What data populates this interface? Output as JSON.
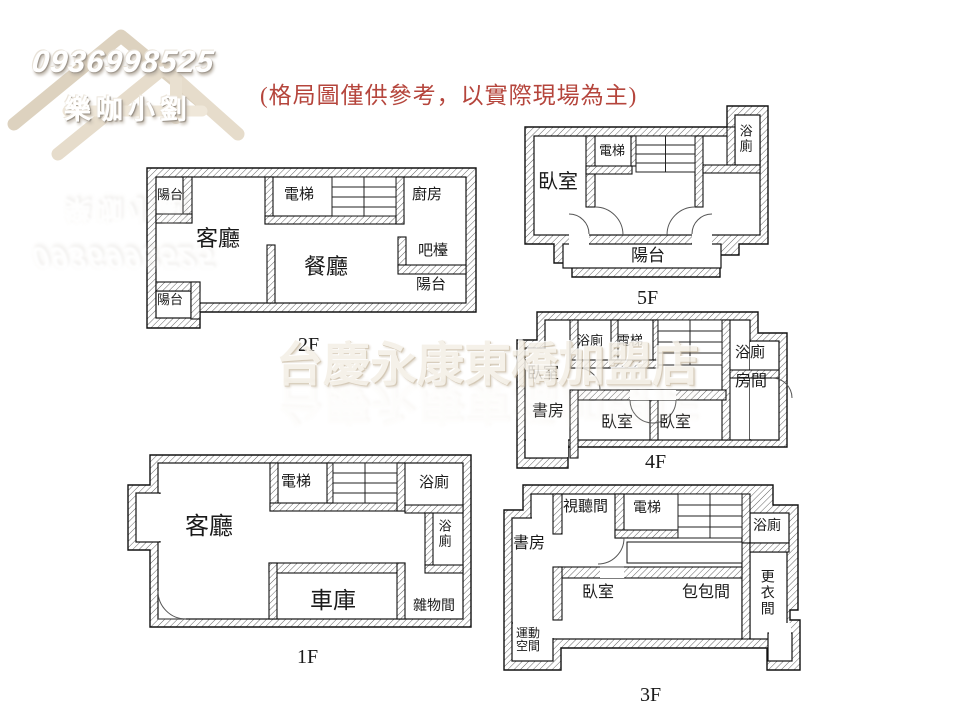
{
  "disclaimer": "(格局圖僅供參考，以實際現場為主)",
  "logo": {
    "phone": "0936998525",
    "name": "樂咖小劉"
  },
  "center_watermark": "台慶永康東橋加盟店",
  "colors": {
    "disclaimer_red": "#b5453c",
    "wall_line": "#111111",
    "hatch_line": "#666666",
    "watermark_beige": "#e9e0d1"
  },
  "floors": {
    "f1": {
      "label": "1F",
      "rooms": {
        "living": "客廳",
        "elevator": "電梯",
        "bath_top": "浴廁",
        "bath_right": "浴廁",
        "garage": "車庫",
        "storage": "雜物間"
      }
    },
    "f2": {
      "label": "2F",
      "rooms": {
        "balcony_tl": "陽台",
        "living": "客廳",
        "elevator": "電梯",
        "kitchen": "廚房",
        "dining": "餐廳",
        "bar": "吧檯",
        "balcony_r": "陽台",
        "balcony_bl": "陽台"
      }
    },
    "f3": {
      "label": "3F",
      "rooms": {
        "study": "書房",
        "av": "視聽間",
        "elevator": "電梯",
        "bath": "浴廁",
        "bedroom": "臥室",
        "bags": "包包間",
        "dressing": "更衣間",
        "exercise": "運動空間"
      }
    },
    "f4": {
      "label": "4F",
      "rooms": {
        "bath_top": "浴廁",
        "elevator": "電梯",
        "bath_right": "浴廁",
        "bedroom_left": "臥室",
        "study": "書房",
        "room": "房間",
        "bedroom_b1": "臥室",
        "bedroom_b2": "臥室"
      }
    },
    "f5": {
      "label": "5F",
      "rooms": {
        "bedroom": "臥室",
        "elevator": "電梯",
        "bath": "浴廁",
        "balcony": "陽台"
      }
    }
  }
}
